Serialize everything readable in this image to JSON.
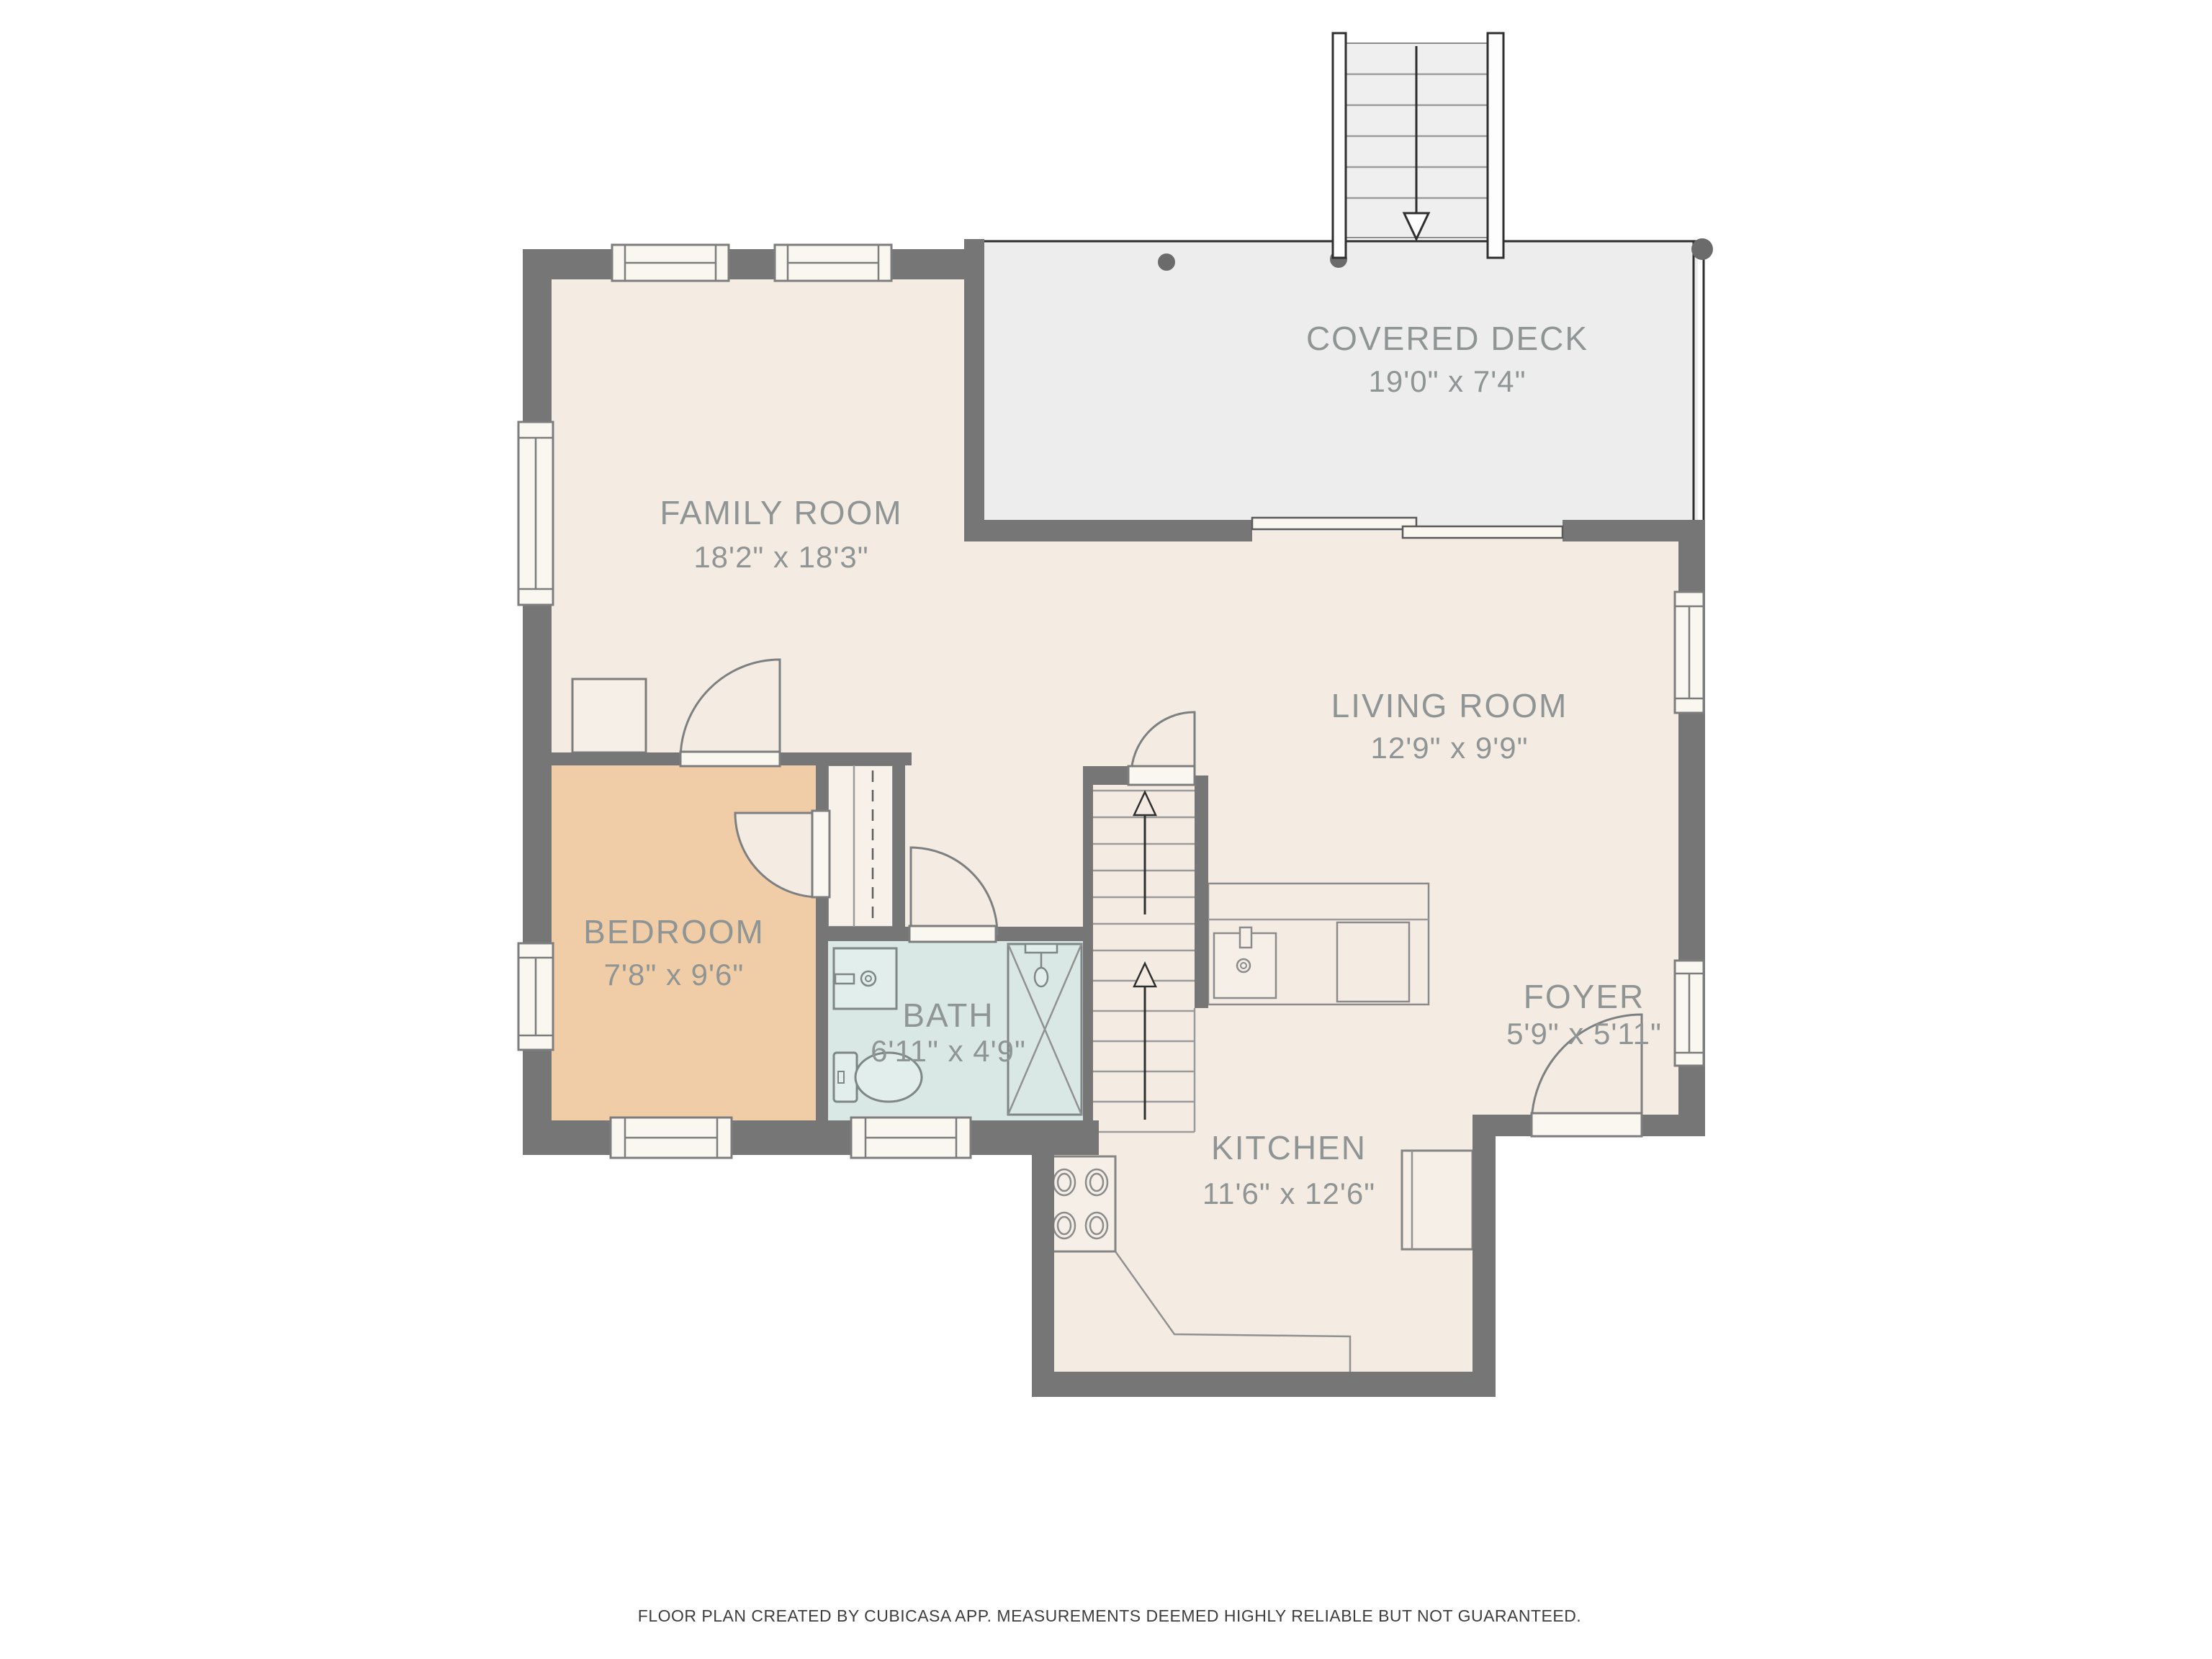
{
  "plan": {
    "type": "floor-plan",
    "creator_note": "FLOOR PLAN CREATED BY CUBICASA APP. MEASUREMENTS DEEMED HIGHLY RELIABLE BUT NOT GUARANTEED."
  },
  "rooms": [
    {
      "id": "covered-deck",
      "name": "COVERED DECK",
      "dims": "19'0\" x 7'4\""
    },
    {
      "id": "family-room",
      "name": "FAMILY ROOM",
      "dims": "18'2\" x 18'3\""
    },
    {
      "id": "living-room",
      "name": "LIVING ROOM",
      "dims": "12'9\" x 9'9\""
    },
    {
      "id": "bedroom",
      "name": "BEDROOM",
      "dims": "7'8\" x 9'6\""
    },
    {
      "id": "bath",
      "name": "BATH",
      "dims": "6'11\" x 4'9\""
    },
    {
      "id": "kitchen",
      "name": "KITCHEN",
      "dims": "11'6\" x 12'6\""
    },
    {
      "id": "foyer",
      "name": "FOYER",
      "dims": "5'9\" x 5'11\""
    }
  ],
  "icons": {
    "stairs_up_arrow": "open triangle arrows pointing up on interior staircase",
    "stairs_down_arrow": "open triangle arrow pointing down on deck staircase"
  },
  "colors": {
    "wall": "#767676",
    "floor_main": "#f4ebe3",
    "floor_bedroom": "#f0cda6",
    "floor_bath": "#d9e7e5",
    "floor_deck": "#ededed",
    "label_text": "#8f9594",
    "footer_text": "#3d3d3d"
  }
}
